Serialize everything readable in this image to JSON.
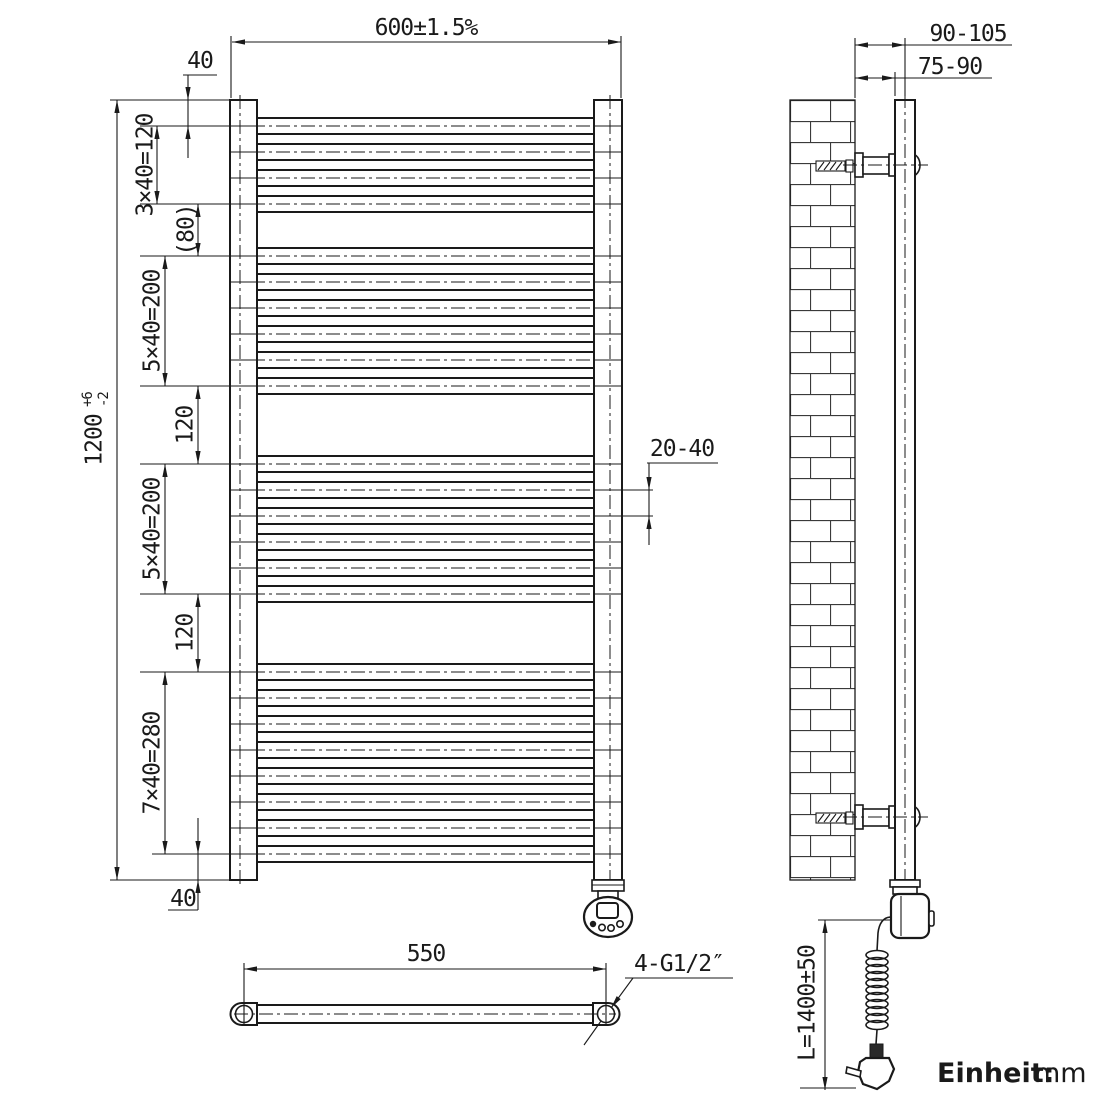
{
  "front_view": {
    "overall_width": "600±1.5%",
    "height": "1200",
    "height_tol_plus": "+6",
    "height_tol_minus": "-2",
    "top_offset": "40",
    "group1_spacing": "3×40=120",
    "gap1": "(80)",
    "group2_spacing": "5×40=200",
    "gap2": "120",
    "group3_spacing": "5×40=200",
    "gap3": "120",
    "group4_spacing": "7×40=280",
    "bottom_offset": "40",
    "hanging_gap": "20-40",
    "bar_centers_mm": [
      40,
      80,
      120,
      160,
      240,
      280,
      320,
      360,
      400,
      440,
      560,
      600,
      640,
      680,
      720,
      760,
      880,
      920,
      960,
      1000,
      1040,
      1080,
      1120,
      1160
    ]
  },
  "side_view": {
    "wall_to_tube_center": "90-105",
    "wall_to_tube_face": "75-90",
    "cable_length": "L=1400±50"
  },
  "bottom_view": {
    "connection_spacing": "550",
    "thread_label": "4-G1/2″"
  },
  "unit_note": {
    "label_bold": "Einheit:",
    "value": "mm",
    "color": "#2222cc"
  }
}
